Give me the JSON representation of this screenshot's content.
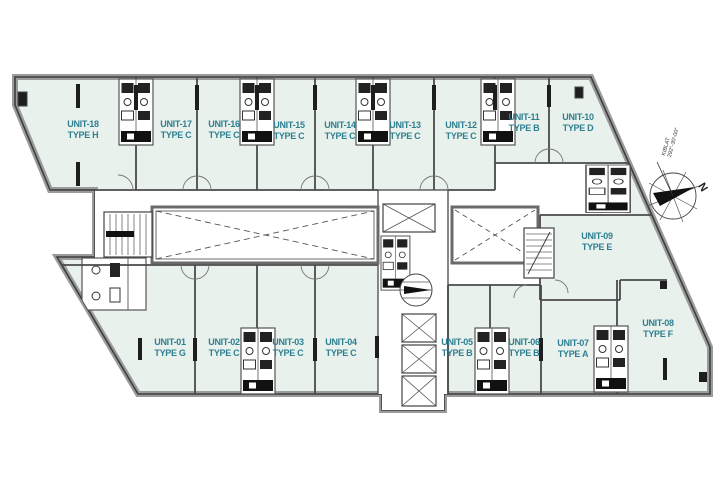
{
  "units": [
    {
      "name": "UNIT-01",
      "type": "TYPE G"
    },
    {
      "name": "UNIT-02",
      "type": "TYPE C"
    },
    {
      "name": "UNIT-03",
      "type": "TYPE C"
    },
    {
      "name": "UNIT-04",
      "type": "TYPE C"
    },
    {
      "name": "UNIT-05",
      "type": "TYPE B"
    },
    {
      "name": "UNIT-06",
      "type": "TYPE B"
    },
    {
      "name": "UNIT-07",
      "type": "TYPE A"
    },
    {
      "name": "UNIT-08",
      "type": "TYPE F"
    },
    {
      "name": "UNIT-09",
      "type": "TYPE E"
    },
    {
      "name": "UNIT-10",
      "type": "TYPE D"
    },
    {
      "name": "UNIT-11",
      "type": "TYPE B"
    },
    {
      "name": "UNIT-12",
      "type": "TYPE C"
    },
    {
      "name": "UNIT-13",
      "type": "TYPE C"
    },
    {
      "name": "UNIT-14",
      "type": "TYPE C"
    },
    {
      "name": "UNIT-15",
      "type": "TYPE C"
    },
    {
      "name": "UNIT-16",
      "type": "TYPE C"
    },
    {
      "name": "UNIT-17",
      "type": "TYPE C"
    },
    {
      "name": "UNIT-18",
      "type": "TYPE H"
    }
  ],
  "compass": {
    "north_label": "N",
    "bearing_line1": "KIBLAT",
    "bearing_line2": "292°-30'-00\""
  },
  "colors": {
    "unit_fill": "#e8f1eb",
    "label_text": "#2e7f92",
    "wall": "#555555"
  }
}
